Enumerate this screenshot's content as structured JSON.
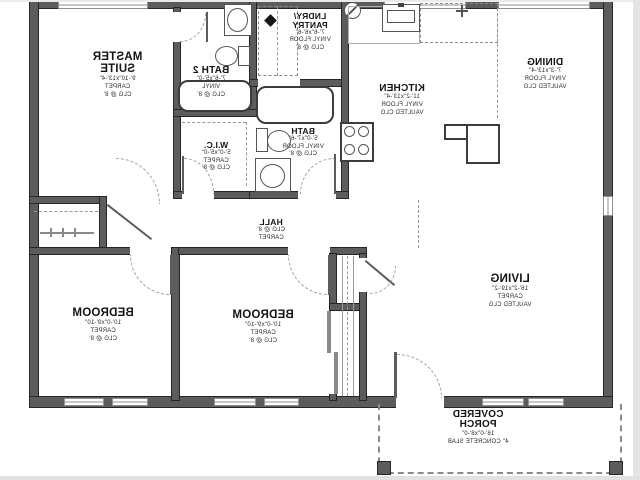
{
  "colors": {
    "background": "#ffffff",
    "wall": "#5c5c5c",
    "text": "#141414",
    "dashed": "#999999"
  },
  "rooms": {
    "master": {
      "name": "MASTER\nSUITE",
      "dims": "9'-10\"x13'-4\"",
      "floor": "CARPET",
      "ceiling": "CLG @ 8'"
    },
    "bath2": {
      "name": "BATH 2",
      "dims": "7'-6\"x5'-0\"",
      "floor": "VINYL",
      "ceiling": "CLG @ 8'"
    },
    "laundry": {
      "name": "LNDRY/\nPANTRY",
      "dims": "7'-6\"x6'-6\"",
      "floor": "VINYL FLOOR",
      "ceiling": "CLG @ 8'"
    },
    "kitchen": {
      "name": "KITCHEN",
      "dims": "11'-2\"x13'-4\"",
      "floor": "VINYL FLOOR",
      "ceiling": "VAULTED CLG"
    },
    "dining": {
      "name": "DINING",
      "dims": "7'-3\"x13'-4\"",
      "floor": "VINYL FLOOR",
      "ceiling": "VAULTED CLG"
    },
    "wic": {
      "name": "W.I.C.",
      "dims": "5'-0\"x5'-0\"",
      "floor": "CARPET",
      "ceiling": "CLG @ 8'"
    },
    "bath": {
      "name": "BATH",
      "dims": "5'-0\"x7'-6\"",
      "floor": "VINYL FLOOR",
      "ceiling": "CLG @ 8'"
    },
    "hall": {
      "name": "HALL",
      "ceiling": "CLG @ 8'",
      "floor": "CARPET"
    },
    "bedroom1": {
      "name": "BEDROOM",
      "dims": "10'-0\"x9'-10\"",
      "floor": "CARPET",
      "ceiling": "CLG @ 8'"
    },
    "bedroom2": {
      "name": "BEDROOM",
      "dims": "10'-0\"x9'-10\"",
      "floor": "CARPET",
      "ceiling": "CLG @ 8'"
    },
    "living": {
      "name": "LIVING",
      "dims": "16'-2\"x19'-2\"",
      "floor": "CARPET",
      "ceiling": "VAULTED CLG"
    },
    "porch": {
      "name": "COVERED\nPORCH",
      "dims": "16'-0\"x8'-0\"",
      "note": "4\" CONCRETE SLAB"
    }
  }
}
